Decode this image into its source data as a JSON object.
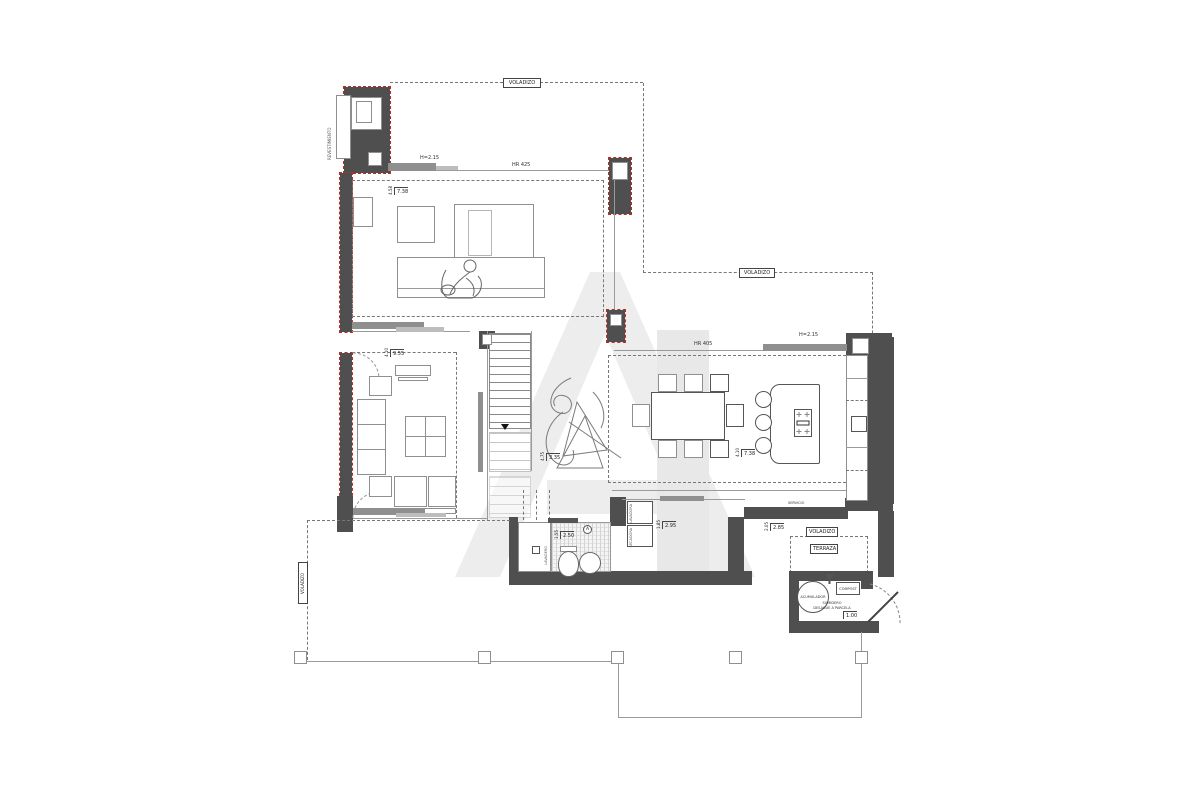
{
  "drawing": {
    "type": "architectural floor plan",
    "overhang_label": "VOLADIZO",
    "terrace_label": "TERRAZA",
    "cladding_label": "REVESTIMIENTO",
    "service_label": "SERVICIO",
    "laundry_room_label": "LAVADERO",
    "washer_label": "LAVADORA",
    "dryer_label": "SECADORA",
    "water_heater_label": "ACUMULADOR",
    "compost_label": "COMPOST",
    "drain_label_1": "SUMIDERO",
    "drain_label_2": "DESAGÜE A PARCELA",
    "bath_key_letter": "A"
  },
  "window_specs": {
    "bedroom_height": "H=2.15",
    "bedroom_ref": "HR 425",
    "kitchen_ref": "HR 405",
    "kitchen_height": "H=2.15"
  },
  "dimensions": {
    "bedroom": {
      "width": "7.38",
      "depth": "4.58"
    },
    "living": {
      "width": "9.55",
      "depth": "4.10"
    },
    "hall": {
      "width": "3.35",
      "depth": "4.75"
    },
    "kitchen_dining": {
      "width": "7.38",
      "depth": "4.10"
    },
    "bathroom": {
      "width": "2.50",
      "depth": "1.55"
    },
    "service": {
      "width": "2.95",
      "depth": "1.85"
    },
    "service_terrace": {
      "width": "2.85",
      "depth": "2.05"
    },
    "machine_room": {
      "width": "1.00"
    }
  },
  "colors": {
    "wall": "#4f4f4f",
    "glazing": "#8f8f8f",
    "red_accent": "#c4291d",
    "line": "#8a8a8a",
    "watermark": "#ededed"
  }
}
